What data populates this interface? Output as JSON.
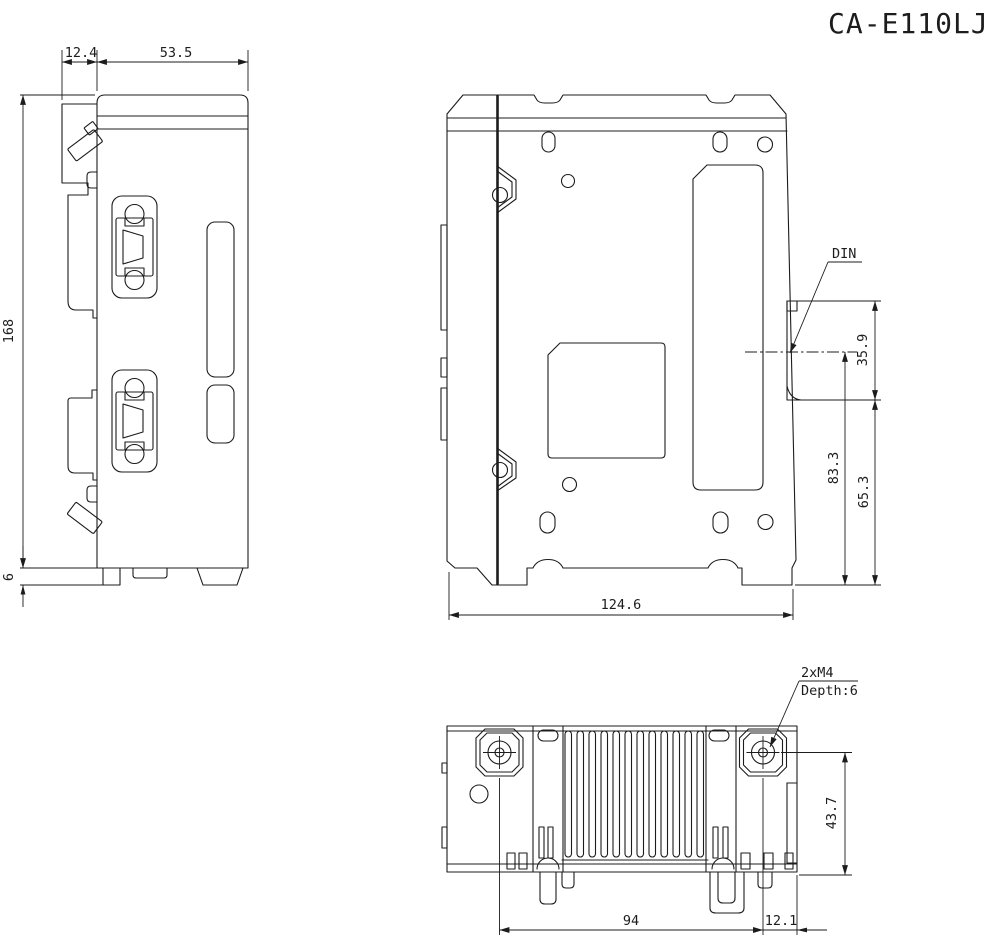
{
  "title": "CA-E110LJ",
  "side": {
    "dim_clip_depth": "12.4",
    "dim_top_width": "53.5",
    "dim_height": "168",
    "dim_foot_height": "6"
  },
  "back": {
    "din_label": "DIN",
    "dim_din_height": "35.9",
    "dim_din_center_to_bottom": "83.3",
    "dim_din_bottom_to_bottom": "65.3",
    "dim_width": "124.6"
  },
  "bottom": {
    "screw_spec": "2xM4",
    "screw_depth": "Depth:6",
    "dim_screw_to_bottom": "43.7",
    "dim_screw_pitch": "94",
    "dim_edge_offset": "12.1"
  },
  "colors": {
    "line": "#1c1c1c",
    "background": "#ffffff"
  }
}
